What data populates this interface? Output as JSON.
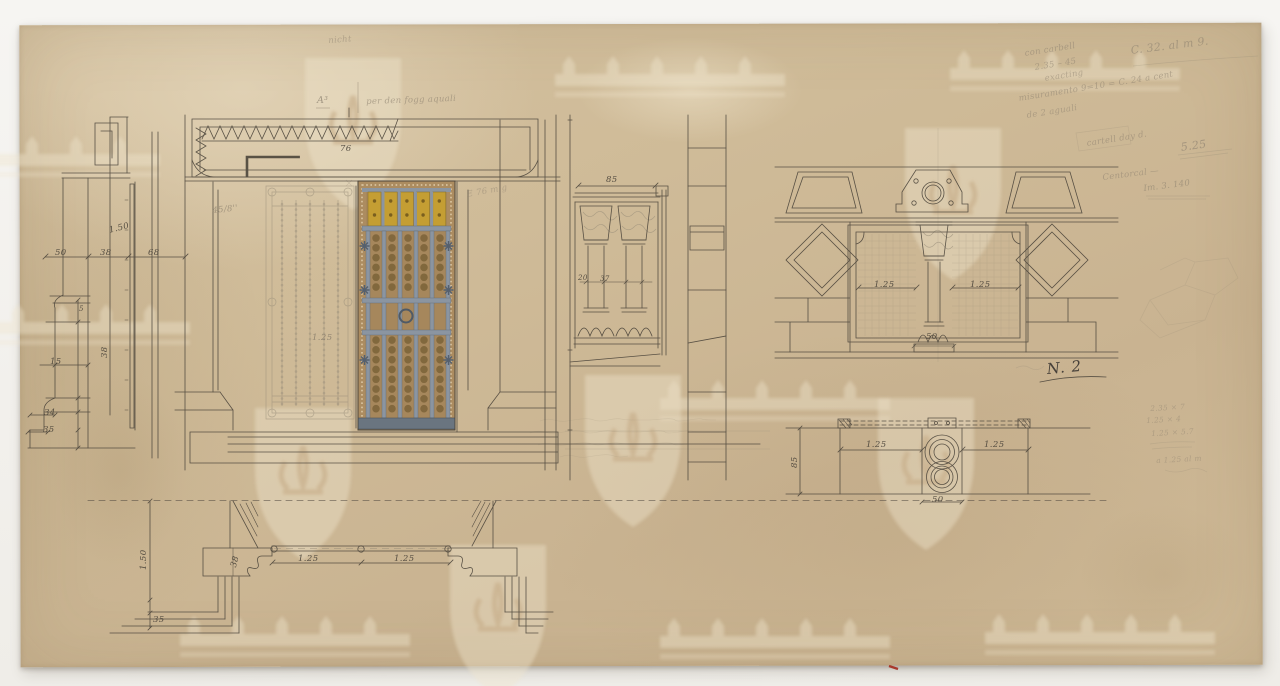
{
  "sheet": {
    "number": "N. 2"
  },
  "dimensions": {
    "section": {
      "row_a": "50",
      "row_b": "38",
      "row_c": "68",
      "height": "1.50",
      "small": "5",
      "v38": "38",
      "d15": "15",
      "d34": "34",
      "d35": "35"
    },
    "lintel": {
      "width": "76"
    },
    "door": {
      "leaf": "1.25"
    },
    "colonnette": {
      "width": "85",
      "shaft": "20",
      "space": "37"
    },
    "bifora": {
      "left": "1.25",
      "right": "1.25",
      "base": "50"
    },
    "plan_window": {
      "depth": "85",
      "left": "1.25",
      "right": "1.25",
      "pier": "50"
    },
    "plan_door": {
      "wall": "1.50",
      "jamb": "38",
      "left": "1.25",
      "right": "1.25",
      "step": "35"
    }
  },
  "pencil_notes": {
    "top": "nicht",
    "ref_mark": "A³",
    "door_note": "per den fogg aquali",
    "jamb_note": "45/8''",
    "lintel_note": "E 76 m g",
    "corner_1": "con carbell",
    "corner_2": "2.35 – 45",
    "corner_3": "exacting",
    "corner_c32": "C. 32. al m 9.",
    "corner_4": "misuramento 9=10 = C. 24 a cent",
    "corner_5": "de 2 aguali",
    "corner_6": "cartell day d.",
    "corner_6b": "5.25",
    "corner_7": "Centorcal —",
    "corner_7b": "Im. 3. 140",
    "calc_1": "2.35 × 7",
    "calc_2": "1.25 × 4",
    "calc_3": "1.25 × 5.7",
    "calc_4": "a 1.25 al m"
  }
}
